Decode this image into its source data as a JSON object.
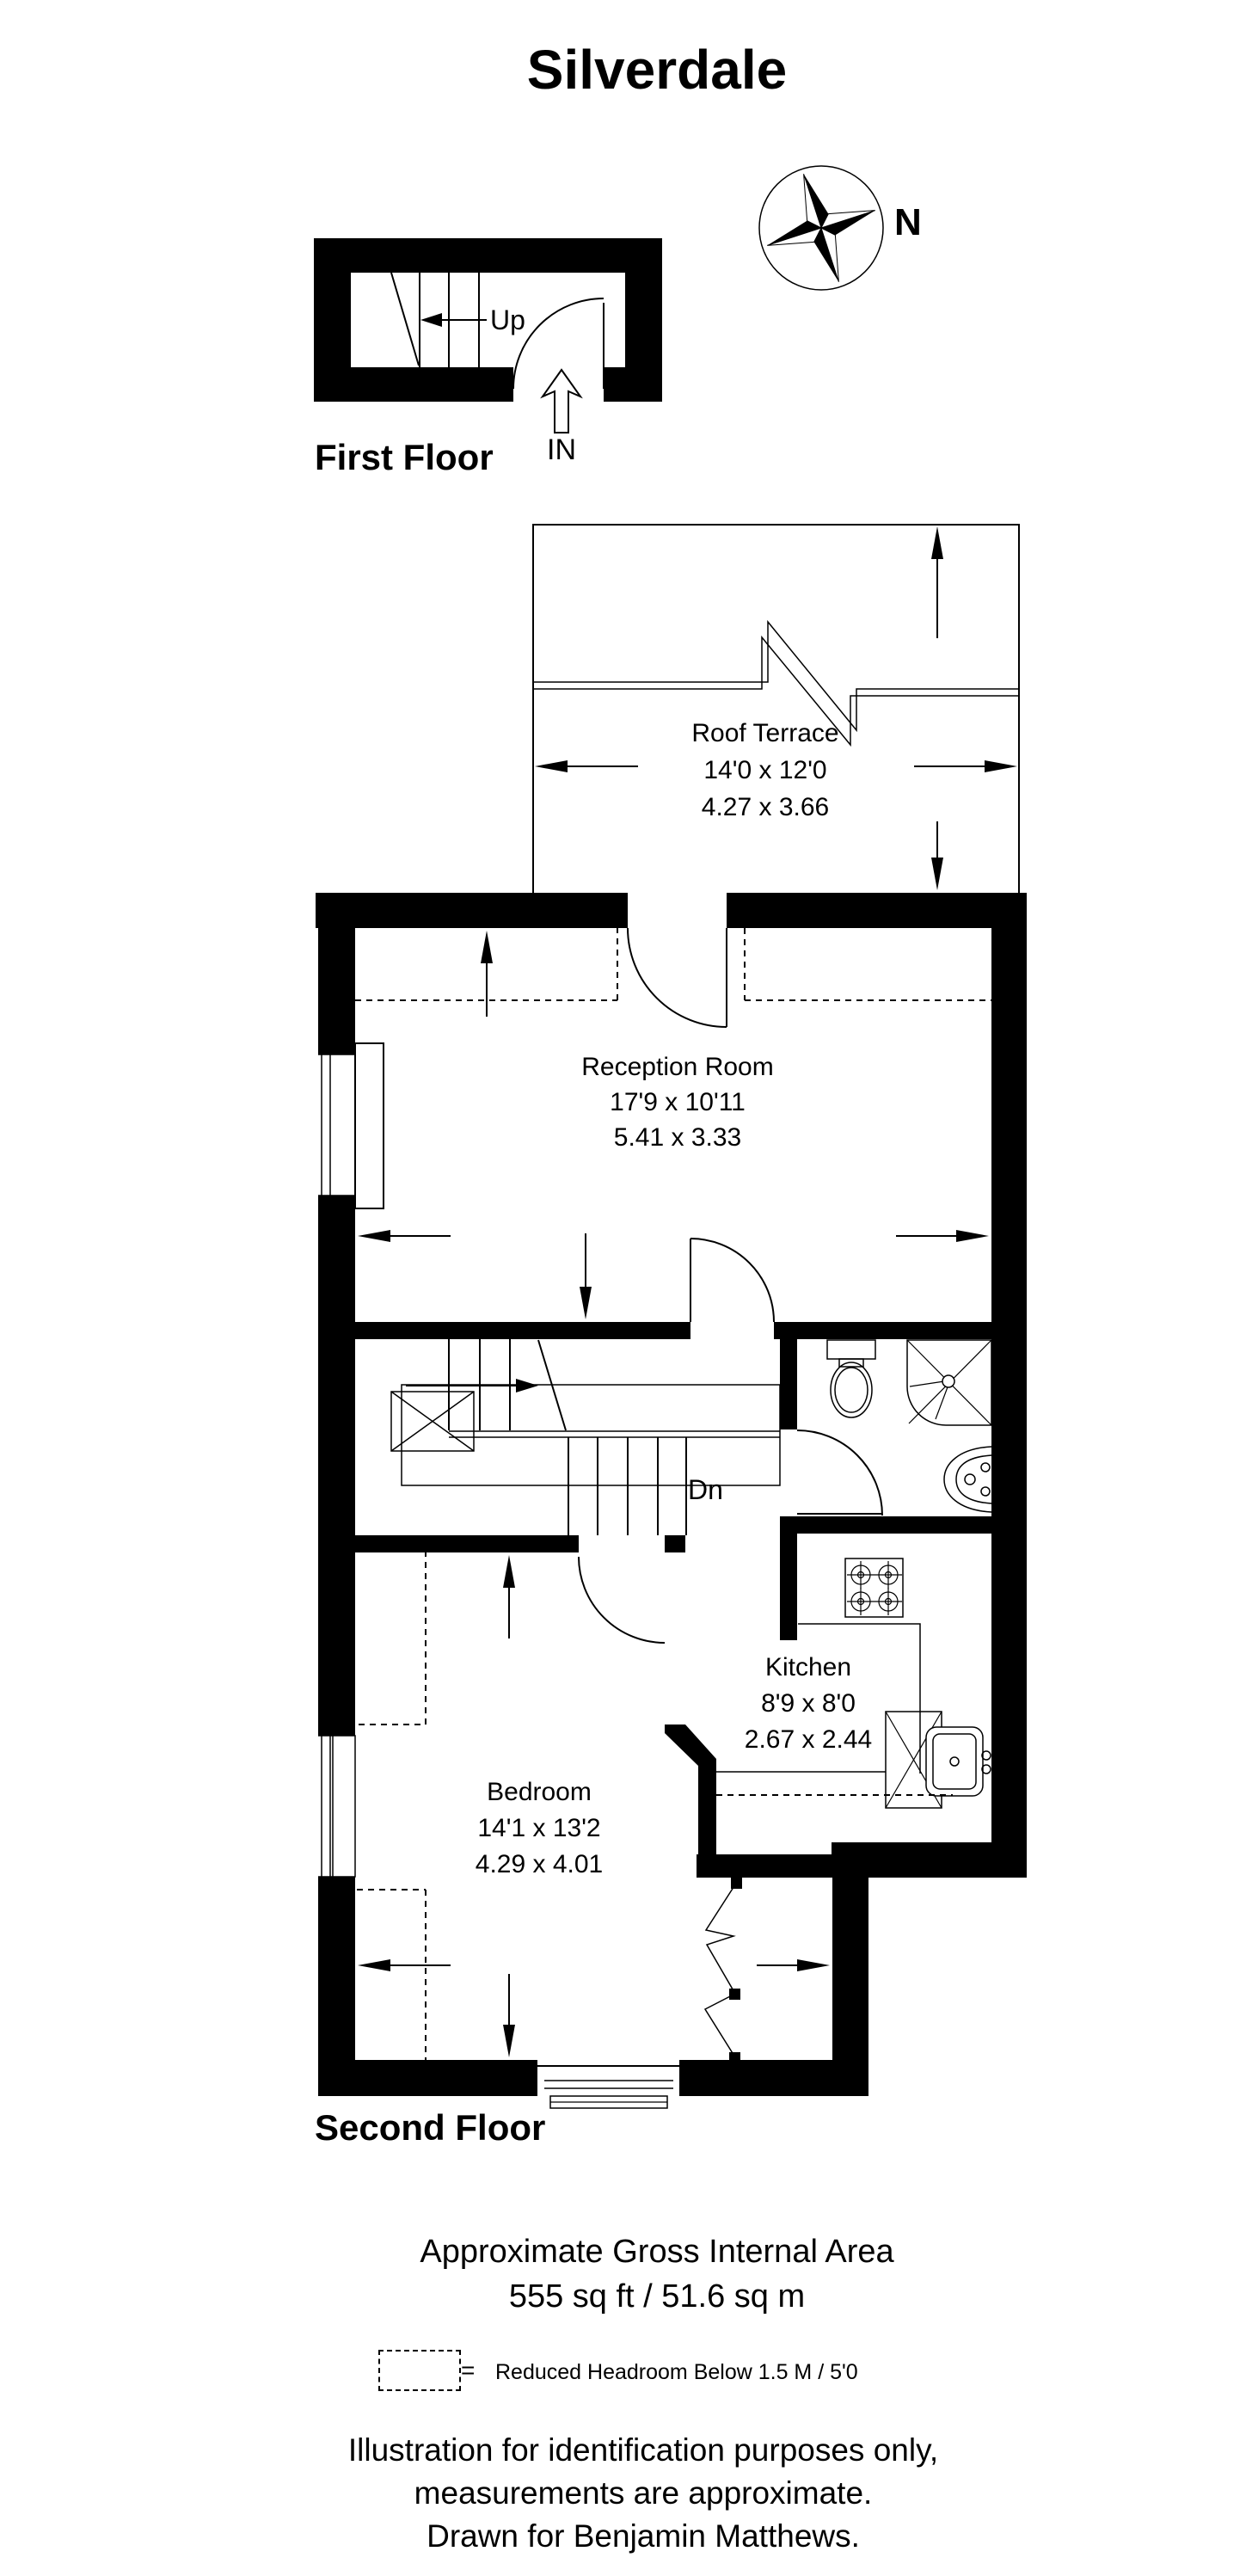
{
  "title": "Silverdale",
  "compass": {
    "north_label": "N"
  },
  "floors": {
    "first": {
      "label": "First Floor",
      "stairs_up": "Up",
      "entrance": "IN"
    },
    "second": {
      "label": "Second Floor"
    }
  },
  "rooms": {
    "roof_terrace": {
      "name": "Roof Terrace",
      "imperial": "14'0 x 12'0",
      "metric": "4.27 x 3.66"
    },
    "reception": {
      "name": "Reception Room",
      "imperial": "17'9 x 10'11",
      "metric": "5.41 x 3.33"
    },
    "kitchen": {
      "name": "Kitchen",
      "imperial": "8'9 x 8'0",
      "metric": "2.67 x 2.44"
    },
    "bedroom": {
      "name": "Bedroom",
      "imperial": "14'1 x 13'2",
      "metric": "4.29 x 4.01"
    }
  },
  "stairs": {
    "down_label": "Dn"
  },
  "summary": {
    "area_title": "Approximate Gross Internal Area",
    "area_value": "555 sq ft / 51.6 sq m"
  },
  "legend": {
    "equals_sign": "=",
    "reduced_headroom": "Reduced Headroom Below 1.5 M / 5'0"
  },
  "disclaimer": {
    "line1": "Illustration for identification purposes only,",
    "line2": "measurements are approximate.",
    "line3": "Drawn for Benjamin Matthews."
  },
  "colors": {
    "ink": "#000000",
    "paper": "#ffffff"
  }
}
